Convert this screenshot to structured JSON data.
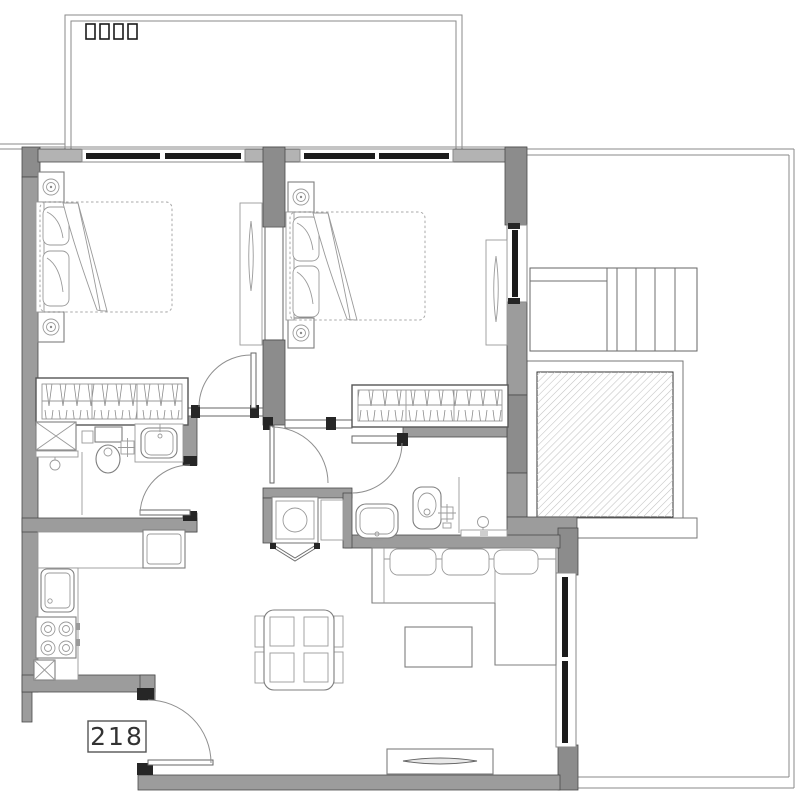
{
  "plan": {
    "unit_label": "218",
    "colors": {
      "background": "#ffffff",
      "wall": "#9c9c9c",
      "wall_dark": "#8c8c8c",
      "wall_light": "#b3b3b3",
      "wall_outline": "#4a4a4a",
      "window_glass": "#1c1c1c",
      "furniture_line": "#7f7f7f",
      "label_text": "#333333"
    },
    "balcony": {
      "vent_slot_count": 4
    },
    "rooms": [
      "balcony",
      "bedroom-1",
      "bedroom-2",
      "bathroom-1",
      "bathroom-2",
      "hallway",
      "laundry-closet",
      "kitchen",
      "living-dining-room",
      "terrace"
    ],
    "fixtures": {
      "bedroom_1": [
        "double-bed",
        "nightstand-with-lamp",
        "nightstand-with-lamp",
        "wardrobe",
        "mirror-cabinet"
      ],
      "bedroom_2": [
        "double-bed",
        "nightstand-with-lamp",
        "nightstand-with-lamp",
        "wardrobe",
        "mirror-cabinet"
      ],
      "bathroom_1": [
        "duct-shaft",
        "shower",
        "toilet",
        "washbasin",
        "floor-drain"
      ],
      "bathroom_2": [
        "washbasin",
        "toilet",
        "floor-drain",
        "shower"
      ],
      "kitchen": [
        "counter",
        "refrigerator",
        "sink",
        "cooktop-4-burner",
        "duct-shaft"
      ],
      "laundry_closet": [
        "washing-machine",
        "side-cabinet",
        "bifold-door"
      ],
      "living_dining": [
        "sofa-l-shaped",
        "coffee-table",
        "dining-table-4-chairs",
        "tv-console"
      ],
      "terrace": [
        "staircase",
        "skylight"
      ]
    },
    "doors": [
      "entry-door",
      "bedroom-1-door",
      "hall-door",
      "bathroom-1-door",
      "bathroom-2-door",
      "sliding-glass-door"
    ],
    "windows": [
      "bedroom-1-window",
      "bedroom-2-window",
      "bedroom-2-side-window"
    ]
  }
}
